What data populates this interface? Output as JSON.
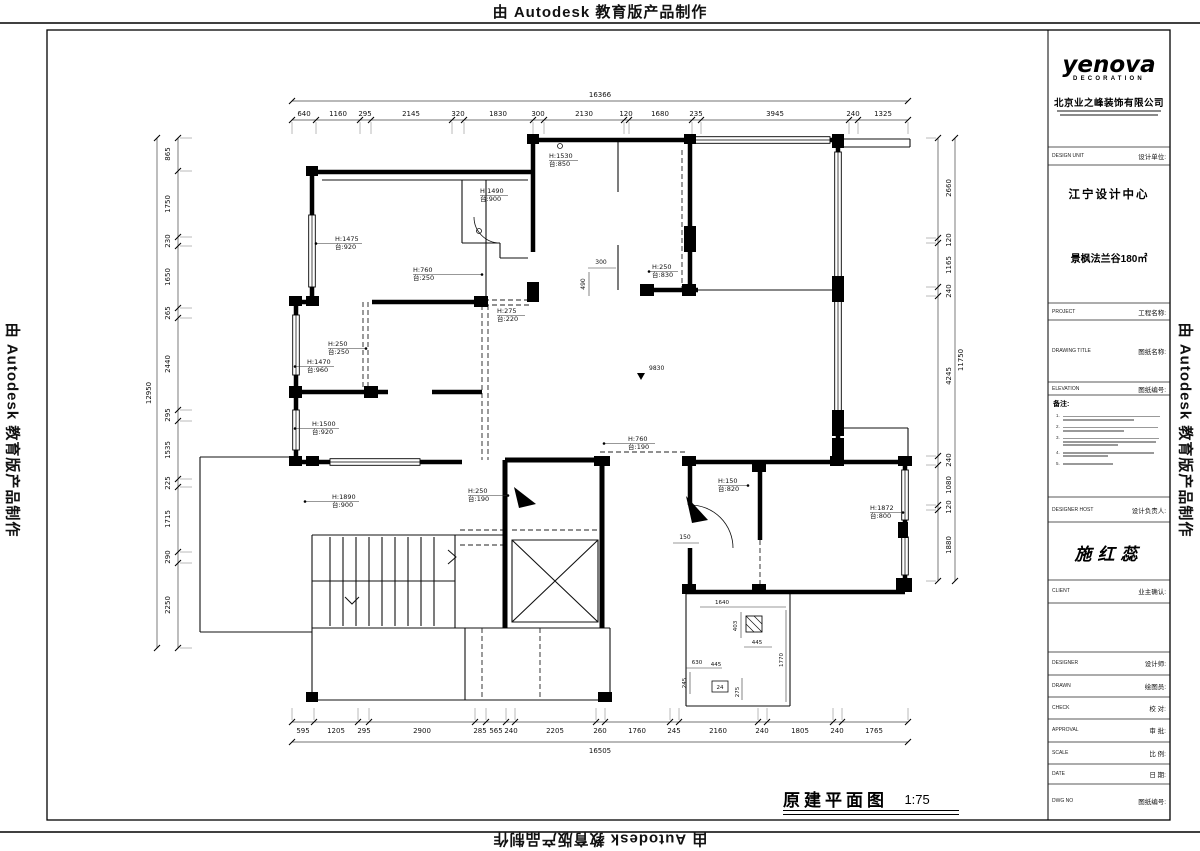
{
  "watermark": {
    "text": "由 Autodesk 教育版产品制作"
  },
  "titleblock": {
    "logo": {
      "name": "yenova",
      "sub": "DECORATION"
    },
    "company": "北京业之峰装饰有限公司",
    "design_unit": {
      "en": "DESIGN UNIT",
      "cn": "设计单位:"
    },
    "center_name": "江宁设计中心",
    "project_name": "景枫法兰谷180㎡",
    "project_row": {
      "en": "PROJECT",
      "cn": "工程名称:"
    },
    "drawing_title_row": {
      "en": "DRAWING TITLE",
      "cn": "图纸名称:"
    },
    "elevation_row": {
      "en": "ELEVATION",
      "cn": "图纸编号:"
    },
    "notes_title": "备注:",
    "notes": [
      {
        "num": "1."
      },
      {
        "num": "2."
      },
      {
        "num": "3."
      },
      {
        "num": "4."
      },
      {
        "num": "5."
      }
    ],
    "designer_host_row": {
      "en": "DESIGNER HOST",
      "cn": "设计负责人:"
    },
    "signature": "施红蕊",
    "client_row": {
      "en": "CLIENT",
      "cn": "业主确认:"
    },
    "bottom_rows": [
      {
        "en": "DESIGNER",
        "cn": "设计师:"
      },
      {
        "en": "DRAWN",
        "cn": "绘图员:"
      },
      {
        "en": "CHECK",
        "cn": "校 对:"
      },
      {
        "en": "APPROVAL",
        "cn": "审 批:"
      },
      {
        "en": "SCALE",
        "cn": "比 例:"
      },
      {
        "en": "DATE",
        "cn": "日 期:"
      },
      {
        "en": "DWG NO",
        "cn": "图纸编号:"
      }
    ]
  },
  "plot_title": {
    "text": "原建平面图",
    "scale": "1:75"
  },
  "plan": {
    "chains": [
      {
        "o": "h",
        "y": 101,
        "t": [
          292,
          908
        ]
      },
      {
        "o": "h",
        "y": 120,
        "t": [
          292,
          316,
          360,
          371,
          452,
          464,
          533,
          544,
          624,
          629,
          692,
          701,
          849,
          858,
          908
        ],
        "e": [
          122,
          134
        ]
      },
      {
        "o": "h",
        "y": 722,
        "t": [
          292,
          314,
          358,
          369,
          475,
          486,
          506,
          515,
          596,
          605,
          670,
          679,
          758,
          767,
          833,
          842,
          908
        ],
        "e": [
          708,
          720
        ]
      },
      {
        "o": "h",
        "y": 742,
        "t": [
          292,
          908
        ]
      },
      {
        "o": "v",
        "x": 178,
        "t": [
          138,
          171,
          237,
          246,
          308,
          318,
          410,
          421,
          479,
          487,
          552,
          563,
          648
        ],
        "e": [
          180,
          192
        ]
      },
      {
        "o": "v",
        "x": 157,
        "t": [
          138,
          648
        ]
      },
      {
        "o": "v",
        "x": 938,
        "t": [
          138,
          238,
          243,
          287,
          296,
          456,
          465,
          505,
          510,
          581
        ],
        "e": [
          926,
          936
        ]
      },
      {
        "o": "v",
        "x": 955,
        "t": [
          138,
          581
        ]
      }
    ],
    "texts": [
      {
        "t": "16366",
        "x": 600,
        "y": 97
      },
      {
        "t": "640",
        "x": 304,
        "y": 116
      },
      {
        "t": "1160",
        "x": 338,
        "y": 116
      },
      {
        "t": "295",
        "x": 365,
        "y": 116
      },
      {
        "t": "2145",
        "x": 411,
        "y": 116
      },
      {
        "t": "320",
        "x": 458,
        "y": 116
      },
      {
        "t": "1830",
        "x": 498,
        "y": 116
      },
      {
        "t": "300",
        "x": 538,
        "y": 116
      },
      {
        "t": "2130",
        "x": 584,
        "y": 116
      },
      {
        "t": "120",
        "x": 626,
        "y": 116
      },
      {
        "t": "1680",
        "x": 660,
        "y": 116
      },
      {
        "t": "235",
        "x": 696,
        "y": 116
      },
      {
        "t": "3945",
        "x": 775,
        "y": 116
      },
      {
        "t": "240",
        "x": 853,
        "y": 116
      },
      {
        "t": "1325",
        "x": 883,
        "y": 116
      },
      {
        "t": "595",
        "x": 303,
        "y": 733
      },
      {
        "t": "1205",
        "x": 336,
        "y": 733
      },
      {
        "t": "295",
        "x": 364,
        "y": 733
      },
      {
        "t": "2900",
        "x": 422,
        "y": 733
      },
      {
        "t": "285",
        "x": 480,
        "y": 733
      },
      {
        "t": "565",
        "x": 496,
        "y": 733
      },
      {
        "t": "240",
        "x": 511,
        "y": 733
      },
      {
        "t": "2205",
        "x": 555,
        "y": 733
      },
      {
        "t": "260",
        "x": 600,
        "y": 733
      },
      {
        "t": "1760",
        "x": 637,
        "y": 733
      },
      {
        "t": "245",
        "x": 674,
        "y": 733
      },
      {
        "t": "2160",
        "x": 718,
        "y": 733
      },
      {
        "t": "240",
        "x": 762,
        "y": 733
      },
      {
        "t": "1805",
        "x": 800,
        "y": 733
      },
      {
        "t": "240",
        "x": 837,
        "y": 733
      },
      {
        "t": "1765",
        "x": 874,
        "y": 733
      },
      {
        "t": "16505",
        "x": 600,
        "y": 753
      },
      {
        "t": "865",
        "x": 170,
        "y": 154,
        "r": -90
      },
      {
        "t": "1750",
        "x": 170,
        "y": 204,
        "r": -90
      },
      {
        "t": "230",
        "x": 170,
        "y": 241,
        "r": -90
      },
      {
        "t": "1650",
        "x": 170,
        "y": 277,
        "r": -90
      },
      {
        "t": "265",
        "x": 170,
        "y": 313,
        "r": -90
      },
      {
        "t": "2440",
        "x": 170,
        "y": 364,
        "r": -90
      },
      {
        "t": "295",
        "x": 170,
        "y": 415,
        "r": -90
      },
      {
        "t": "1535",
        "x": 170,
        "y": 450,
        "r": -90
      },
      {
        "t": "225",
        "x": 170,
        "y": 483,
        "r": -90
      },
      {
        "t": "1715",
        "x": 170,
        "y": 519,
        "r": -90
      },
      {
        "t": "290",
        "x": 170,
        "y": 557,
        "r": -90
      },
      {
        "t": "2250",
        "x": 170,
        "y": 605,
        "r": -90
      },
      {
        "t": "12950",
        "x": 151,
        "y": 393,
        "r": -90
      },
      {
        "t": "2660",
        "x": 951,
        "y": 188,
        "r": -90
      },
      {
        "t": "120",
        "x": 951,
        "y": 240,
        "r": -90
      },
      {
        "t": "1165",
        "x": 951,
        "y": 265,
        "r": -90
      },
      {
        "t": "240",
        "x": 951,
        "y": 291,
        "r": -90
      },
      {
        "t": "4245",
        "x": 951,
        "y": 376,
        "r": -90
      },
      {
        "t": "240",
        "x": 951,
        "y": 460,
        "r": -90
      },
      {
        "t": "1080",
        "x": 951,
        "y": 485,
        "r": -90
      },
      {
        "t": "120",
        "x": 951,
        "y": 507,
        "r": -90
      },
      {
        "t": "1880",
        "x": 951,
        "y": 545,
        "r": -90
      },
      {
        "t": "11750",
        "x": 963,
        "y": 360,
        "r": -90
      },
      {
        "t": "H:1530",
        "x": 549,
        "y": 158,
        "s": 6.5,
        "a": "start"
      },
      {
        "t": "台:850",
        "x": 549,
        "y": 166,
        "s": 6.5,
        "a": "start"
      },
      {
        "t": "H:1490",
        "x": 480,
        "y": 193,
        "s": 6.5,
        "a": "start"
      },
      {
        "t": "台:900",
        "x": 480,
        "y": 201,
        "s": 6.5,
        "a": "start"
      },
      {
        "t": "H:1475",
        "x": 335,
        "y": 241,
        "s": 6.5,
        "a": "start"
      },
      {
        "t": "台:920",
        "x": 335,
        "y": 249,
        "s": 6.5,
        "a": "start"
      },
      {
        "t": "H:760",
        "x": 413,
        "y": 272,
        "s": 6.5,
        "a": "start"
      },
      {
        "t": "台:250",
        "x": 413,
        "y": 280,
        "s": 6.5,
        "a": "start"
      },
      {
        "t": "H:250",
        "x": 652,
        "y": 269,
        "s": 6.5,
        "a": "start"
      },
      {
        "t": "台:830",
        "x": 652,
        "y": 277,
        "s": 6.5,
        "a": "start"
      },
      {
        "t": "H:275",
        "x": 497,
        "y": 313,
        "s": 6.5,
        "a": "start"
      },
      {
        "t": "台:220",
        "x": 497,
        "y": 321,
        "s": 6.5,
        "a": "start"
      },
      {
        "t": "H:250",
        "x": 328,
        "y": 346,
        "s": 6.5,
        "a": "start"
      },
      {
        "t": "台:250",
        "x": 328,
        "y": 354,
        "s": 6.5,
        "a": "start"
      },
      {
        "t": "H:1470",
        "x": 307,
        "y": 364,
        "s": 6.5,
        "a": "start"
      },
      {
        "t": "台:960",
        "x": 307,
        "y": 372,
        "s": 6.5,
        "a": "start"
      },
      {
        "t": "H:1500",
        "x": 312,
        "y": 426,
        "s": 6.5,
        "a": "start"
      },
      {
        "t": "台:920",
        "x": 312,
        "y": 434,
        "s": 6.5,
        "a": "start"
      },
      {
        "t": "H:1890",
        "x": 332,
        "y": 499,
        "s": 6.5,
        "a": "start"
      },
      {
        "t": "台:900",
        "x": 332,
        "y": 507,
        "s": 6.5,
        "a": "start"
      },
      {
        "t": "H:250",
        "x": 468,
        "y": 493,
        "s": 6.5,
        "a": "start"
      },
      {
        "t": "台:190",
        "x": 468,
        "y": 501,
        "s": 6.5,
        "a": "start"
      },
      {
        "t": "H:760",
        "x": 628,
        "y": 441,
        "s": 6.5,
        "a": "start"
      },
      {
        "t": "台:190",
        "x": 628,
        "y": 449,
        "s": 6.5,
        "a": "start"
      },
      {
        "t": "H:150",
        "x": 718,
        "y": 483,
        "s": 6.5,
        "a": "start"
      },
      {
        "t": "台:820",
        "x": 718,
        "y": 491,
        "s": 6.5,
        "a": "start"
      },
      {
        "t": "H:1872",
        "x": 870,
        "y": 510,
        "s": 6.5,
        "a": "start"
      },
      {
        "t": "台:800",
        "x": 870,
        "y": 518,
        "s": 6.5,
        "a": "start"
      },
      {
        "t": "300",
        "x": 601,
        "y": 264,
        "s": 6
      },
      {
        "t": "490",
        "x": 585,
        "y": 284,
        "s": 6,
        "r": -90
      },
      {
        "t": "150",
        "x": 685,
        "y": 539,
        "s": 6
      },
      {
        "t": "9830",
        "x": 649,
        "y": 370,
        "s": 6,
        "a": "start"
      },
      {
        "t": "1640",
        "x": 722,
        "y": 604,
        "s": 5.5
      },
      {
        "t": "403",
        "x": 737,
        "y": 626,
        "s": 5.5,
        "r": -90
      },
      {
        "t": "445",
        "x": 757,
        "y": 644,
        "s": 5.5
      },
      {
        "t": "630",
        "x": 697,
        "y": 664,
        "s": 5.5
      },
      {
        "t": "445",
        "x": 716,
        "y": 666,
        "s": 5.5
      },
      {
        "t": "245",
        "x": 686,
        "y": 683,
        "s": 5.5,
        "r": -90
      },
      {
        "t": "275",
        "x": 739,
        "y": 692,
        "s": 5.5,
        "r": -90
      },
      {
        "t": "1770",
        "x": 783,
        "y": 660,
        "s": 5.5,
        "r": -90
      },
      {
        "t": "24",
        "x": 720,
        "y": 689,
        "s": 5.5
      }
    ],
    "lines": [
      [
        549,
        160.5,
        578,
        160.5
      ],
      [
        480,
        195.5,
        508,
        195.5
      ],
      [
        316,
        243.5,
        362,
        243.5
      ],
      [
        413,
        274.5,
        482,
        274.5
      ],
      [
        649,
        271.5,
        678,
        271.5
      ],
      [
        497,
        315.5,
        525,
        315.5
      ],
      [
        328,
        348.5,
        366,
        348.5
      ],
      [
        295,
        366.5,
        334,
        366.5
      ],
      [
        295,
        428.5,
        339,
        428.5
      ],
      [
        305,
        501.5,
        359,
        501.5
      ],
      [
        468,
        495.5,
        508,
        495.5
      ],
      [
        604,
        443.5,
        655,
        443.5
      ],
      [
        718,
        485.5,
        748,
        485.5
      ],
      [
        870,
        512.5,
        903,
        512.5
      ],
      [
        588,
        268,
        616,
        268
      ],
      [
        589,
        272,
        589,
        296
      ],
      [
        673,
        543,
        699,
        543
      ],
      [
        700,
        607,
        786,
        607
      ],
      [
        741,
        612,
        741,
        638
      ],
      [
        744,
        647,
        772,
        647
      ],
      [
        686,
        668,
        722,
        668
      ],
      [
        690,
        672,
        690,
        694
      ],
      [
        742,
        678,
        742,
        700
      ],
      [
        786,
        610,
        786,
        702
      ]
    ],
    "dots": [
      [
        316,
        243.5
      ],
      [
        482,
        274.5
      ],
      [
        649,
        271.5
      ],
      [
        366,
        348.5
      ],
      [
        295,
        366.5
      ],
      [
        295,
        428.5
      ],
      [
        305,
        501.5
      ],
      [
        508,
        495.5
      ],
      [
        604,
        443.5
      ],
      [
        748,
        485.5
      ],
      [
        903,
        512.5
      ]
    ]
  }
}
